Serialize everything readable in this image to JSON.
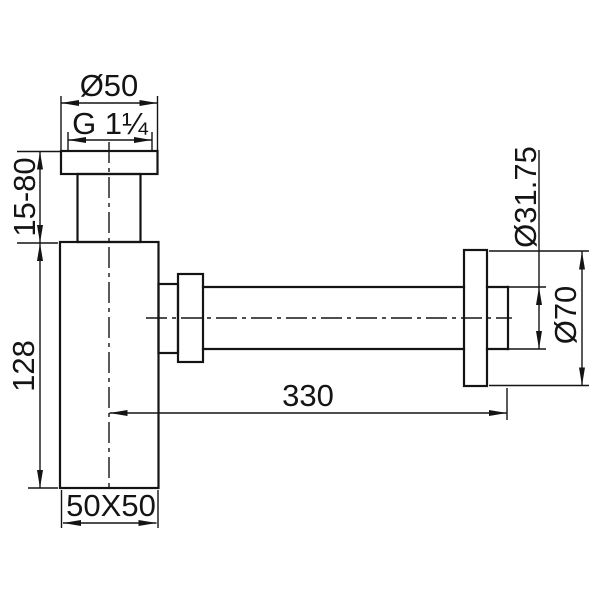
{
  "drawing": {
    "title": "bottle-trap technical drawing",
    "background_color": "#ffffff",
    "line_color": "#141414",
    "dimensions": {
      "top_flange_diameter": "Ø50",
      "thread_size": "G 1¼",
      "inlet_height_range": "15-80",
      "body_height": "128",
      "outlet_length": "330",
      "body_section": "50X50",
      "outlet_pipe_diameter": "Ø31.75",
      "wall_flange_diameter": "Ø70"
    }
  }
}
